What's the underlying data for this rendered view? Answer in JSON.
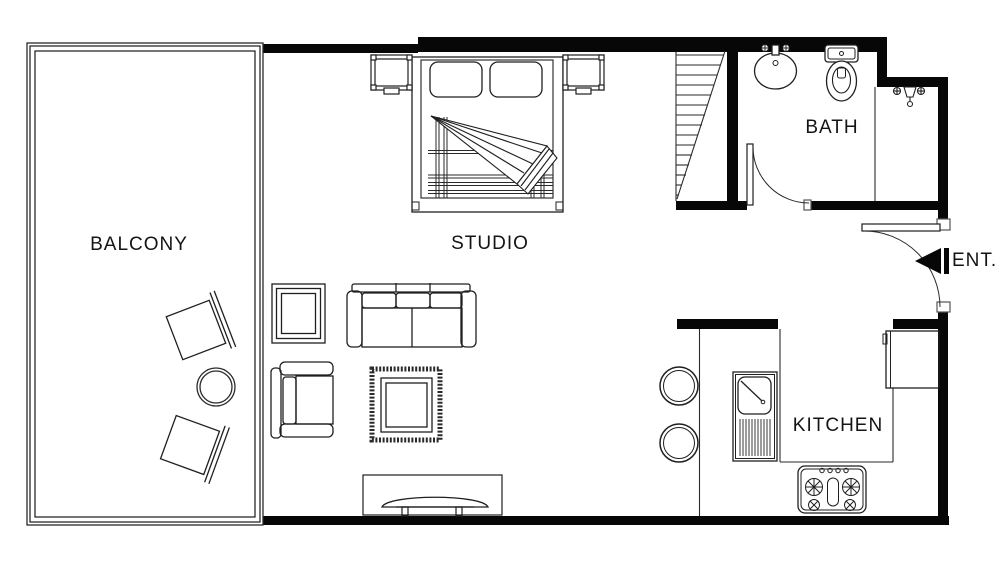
{
  "meta": {
    "type": "floor-plan",
    "description": "studio apartment floor plan, top view, black line drawing on white"
  },
  "colors": {
    "background": "#ffffff",
    "wall": "#070707",
    "line": "#1f1f1f",
    "text": "#141414"
  },
  "rooms": {
    "balcony": {
      "label": "BALCONY"
    },
    "studio": {
      "label": "STUDIO"
    },
    "bath": {
      "label": "BATH"
    },
    "kitchen": {
      "label": "KITCHEN"
    },
    "entrance": {
      "label": "ENT."
    }
  },
  "symbols": {
    "entry_marker": "solid left-pointing triangle with bar at entrance door"
  },
  "furniture": [
    "double-bed",
    "nightstand-left",
    "nightstand-right",
    "sofa",
    "armchair",
    "side-table",
    "area-rug-with-coffee-table",
    "tv-console",
    "balcony-chair-upper",
    "balcony-chair-lower",
    "balcony-round-table",
    "staircase",
    "bathroom-sink",
    "toilet",
    "shower-head",
    "shower-glass-partition",
    "bath-door",
    "entrance-door",
    "kitchen-sink",
    "gas-stove-4-burner",
    "refrigerator",
    "bar-stool-upper",
    "bar-stool-lower"
  ]
}
